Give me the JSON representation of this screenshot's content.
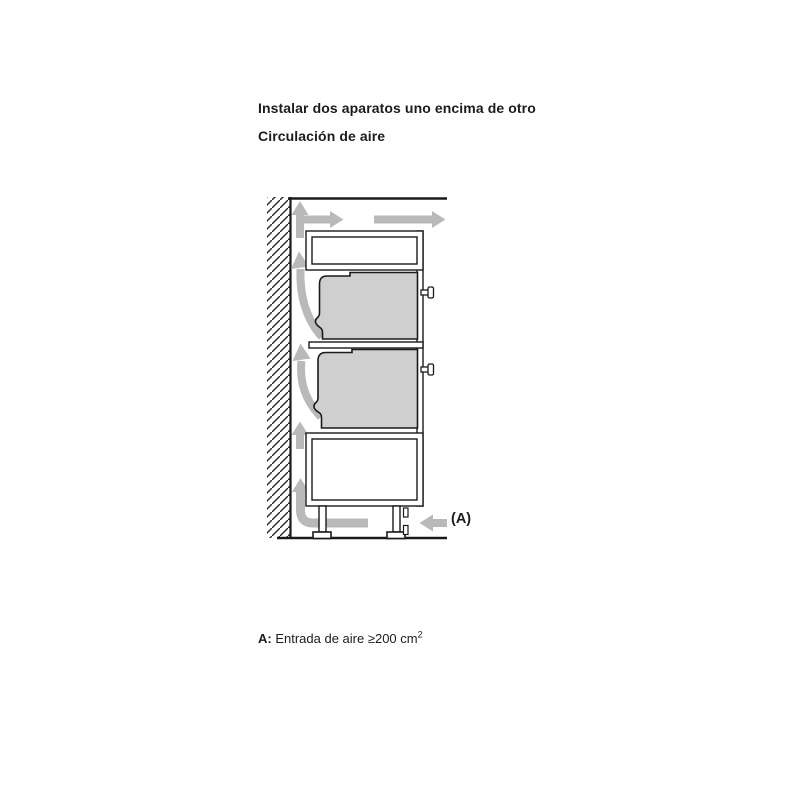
{
  "page": {
    "title": "Instalar dos aparatos uno encima de otro",
    "subtitle": "Circulación de aire"
  },
  "diagram": {
    "inlet_label": "(A)",
    "colors": {
      "ink": "#1a1a1a",
      "appliance_fill": "#cfcfcf",
      "airflow_arrow": "#b9b9b9",
      "background": "#ffffff"
    }
  },
  "caption": {
    "key": "A:",
    "text": " Entrada de aire ≥200 cm",
    "sup": "2"
  }
}
